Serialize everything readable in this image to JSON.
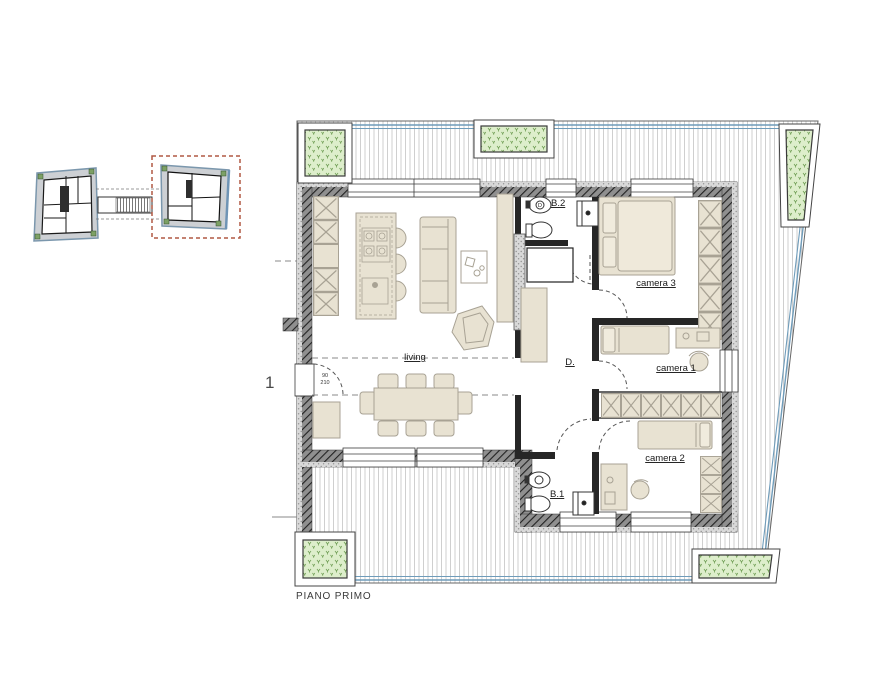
{
  "plan": {
    "floor_label": "PIANO PRIMO",
    "unit_number": "1",
    "rooms": {
      "living": "living",
      "corridor": "D.",
      "bath1": "B.1",
      "bath2": "B.2",
      "bedroom1": "camera 1",
      "bedroom2": "camera 2",
      "bedroom3": "camera 3"
    },
    "door_dimensions": {
      "width": "90",
      "height": "210"
    },
    "symbols": {
      "bath2_fixture": "D"
    }
  },
  "colors": {
    "wall": "#8f8f8f",
    "wall_hatch": "#222222",
    "insulation": "#d9d9d9",
    "furniture": "#e8e2d2",
    "furniture_stroke": "#a8a294",
    "planter_fill": "#ddeecb",
    "planter_glyph": "#6f9e54",
    "railing_blue": "#6f9cba",
    "deck_line": "#cfcfcf",
    "keyplan_fill": "#cdd0d4",
    "keyplan_outline": "#7b97ad",
    "highlight_red": "#b05844"
  }
}
